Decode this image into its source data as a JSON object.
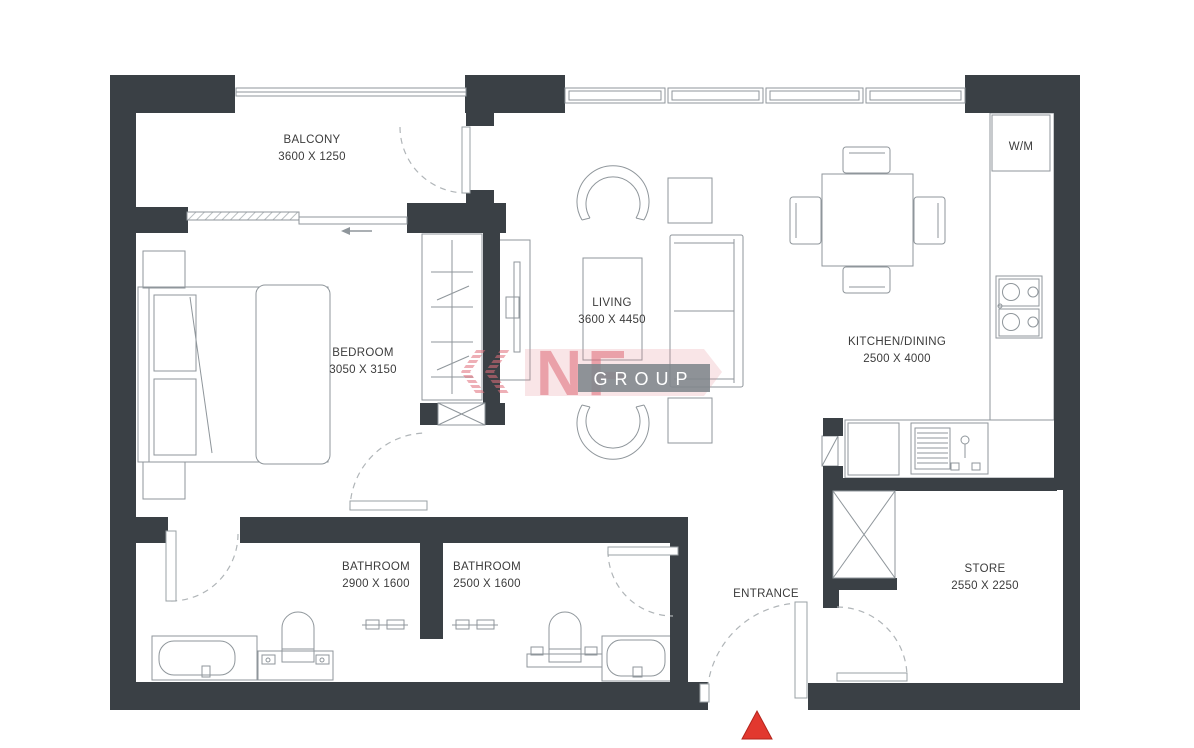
{
  "title": "apartment-floor-plan",
  "rooms": {
    "balcony": {
      "label": "BALCONY",
      "dims": "3600 X 1250"
    },
    "bedroom": {
      "label": "BEDROOM",
      "dims": "3050 X 3150"
    },
    "living": {
      "label": "LIVING",
      "dims": "3600 X 4450"
    },
    "kitchen_dining": {
      "label": "KITCHEN/DINING",
      "dims": "2500 X 4000"
    },
    "bathroom_1": {
      "label": "BATHROOM",
      "dims": "2900 X 1600"
    },
    "bathroom_2": {
      "label": "BATHROOM",
      "dims": "2500 X 1600"
    },
    "store": {
      "label": "STORE",
      "dims": "2550 X 2250"
    },
    "entrance": {
      "label": "ENTRANCE"
    },
    "washer": {
      "label": "W/M"
    }
  },
  "watermark": {
    "brand": "NF",
    "word": "GROUP"
  },
  "colors": {
    "wall": "#3a4045",
    "thin_line": "#8f969b",
    "label_text": "#3c3c3c",
    "entrance_marker": "#e2382f",
    "watermark_pink": "#df6a76",
    "watermark_gray": "#7e868c"
  }
}
